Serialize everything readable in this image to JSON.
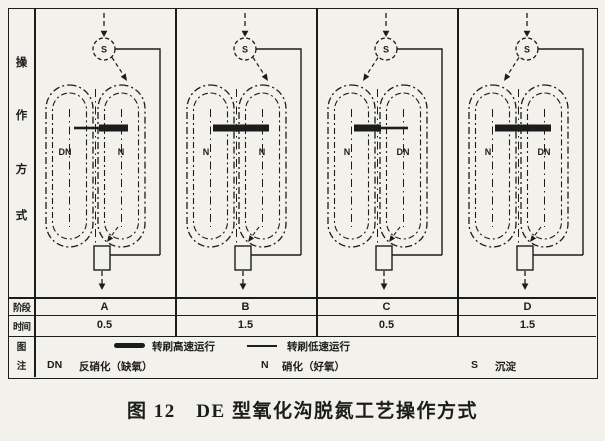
{
  "figure": {
    "caption": "图 12　DE 型氧化沟脱氮工艺操作方式"
  },
  "row_headers": {
    "mode_chars": [
      "操",
      "作",
      "方",
      "式"
    ],
    "stage": "阶段",
    "time": "时间",
    "legend_chars": [
      "图",
      "注"
    ]
  },
  "clarifier_label": "S",
  "stages": [
    {
      "stage": "A",
      "time": "0.5",
      "left_zone": "DN",
      "right_zone": "N",
      "left_brush": "low",
      "right_brush": "high",
      "feed": "right"
    },
    {
      "stage": "B",
      "time": "1.5",
      "left_zone": "N",
      "right_zone": "N",
      "left_brush": "high",
      "right_brush": "high",
      "feed": "right"
    },
    {
      "stage": "C",
      "time": "0.5",
      "left_zone": "N",
      "right_zone": "DN",
      "left_brush": "high",
      "right_brush": "low",
      "feed": "left"
    },
    {
      "stage": "D",
      "time": "1.5",
      "left_zone": "N",
      "right_zone": "DN",
      "left_brush": "high",
      "right_brush": "high",
      "feed": "left"
    }
  ],
  "legend": {
    "high_speed_label": "转刷高速运行",
    "low_speed_label": "转刷低速运行",
    "dn_symbol": "DN",
    "dn_label": "反硝化（缺氧）",
    "n_symbol": "N",
    "n_label": "硝化（好氧）",
    "s_symbol": "S",
    "s_label": "沉淀"
  },
  "colors": {
    "ink": "#1c1c1c",
    "paper": "#f3f1ec"
  }
}
